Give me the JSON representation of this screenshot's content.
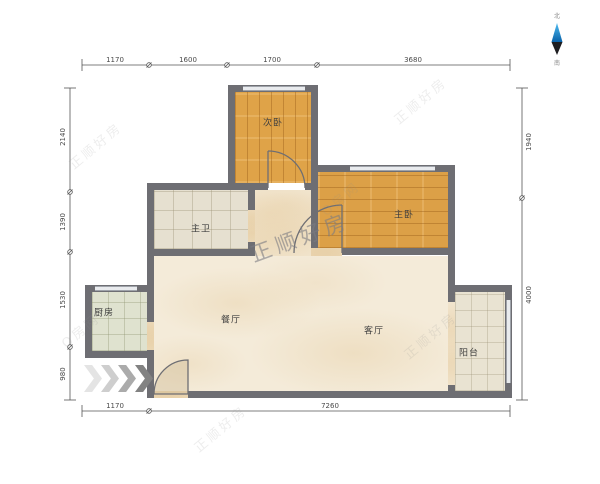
{
  "rooms": {
    "bedroom2": "次卧",
    "bedroom1": "主卧",
    "bathroom": "主卫",
    "kitchen": "厨房",
    "dining": "餐厅",
    "living": "客厅",
    "balcony": "阳台"
  },
  "dimensions": {
    "top": [
      "1170",
      "1600",
      "1700",
      "3680"
    ],
    "left": [
      "2140",
      "1390",
      "1530",
      "980"
    ],
    "right": [
      "1940",
      "4000"
    ],
    "bottom": [
      "1170",
      "7260"
    ]
  },
  "watermark": {
    "main": "正顺好房",
    "alt": "O房网"
  },
  "compass": {
    "north": "北",
    "south": "南"
  },
  "colors": {
    "wall": "#6e6e73",
    "wood_floor": "#dfa348",
    "tile_floor": "#e6e0d0",
    "marble_floor": "#f4ebd9",
    "compass_blue": "#1d8fd1"
  }
}
